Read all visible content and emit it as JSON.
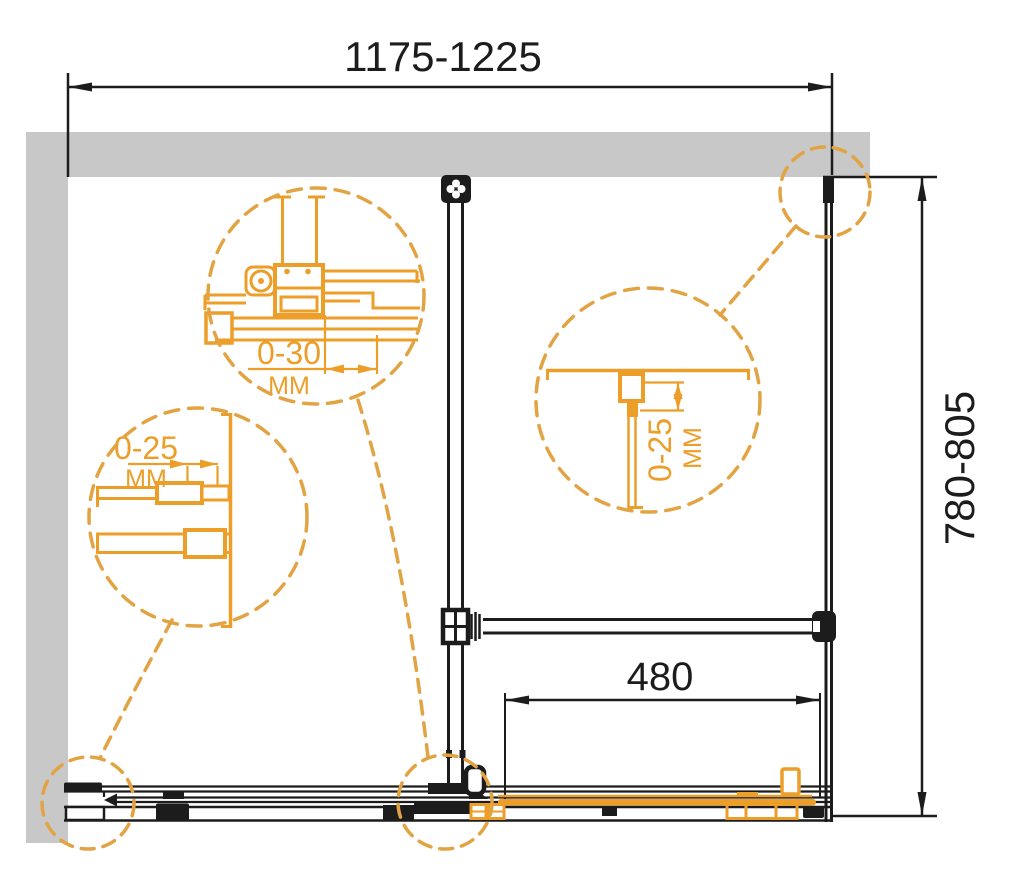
{
  "drawing": {
    "dimensions": {
      "width": "1175-1225",
      "depth": "780-805",
      "opening": "480"
    },
    "details": {
      "roller_adjust": {
        "value": "0-30",
        "unit": "MM"
      },
      "left_profile_adjust": {
        "value": "0-25",
        "unit": "MM"
      },
      "right_profile_adjust": {
        "value": "0-25",
        "unit": "MM"
      }
    },
    "colors": {
      "accent_orange": "#EC9E29",
      "dashed_orange": "#E2A343",
      "wall_gray": "#C8C8C8",
      "line_black": "#1C1C1C"
    }
  }
}
